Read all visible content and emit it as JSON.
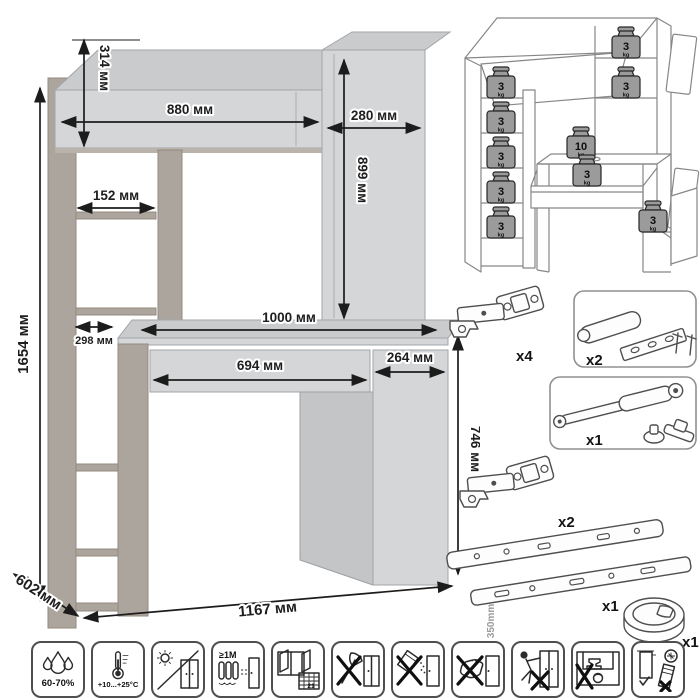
{
  "dimensions": {
    "total_height": "1654 мм",
    "hutch_height": "314 мм",
    "hutch_width": "880 мм",
    "side_cabinet_width": "280 мм",
    "side_cabinet_height": "899 мм",
    "shelf_width": "152 мм",
    "shelf_depth": "298 мм",
    "desktop_width": "1000 мм",
    "drawer_width": "694 мм",
    "pedestal_width": "264 мм",
    "desk_height": "746 мм",
    "depth": "602 мм",
    "total_width": "1167 мм"
  },
  "load": {
    "unit": "kg",
    "weights": [
      "3",
      "3",
      "3",
      "3",
      "3",
      "3",
      "3",
      "10",
      "3",
      "3"
    ]
  },
  "hardware": {
    "hinge_top_qty": "x4",
    "damper_qty": "x2",
    "gas_lift_qty": "x1",
    "hinge_bottom_qty": "x2",
    "slides_qty": "x1",
    "slides_length": "350mm",
    "grommet_qty": "x1"
  },
  "care": {
    "humidity": "60-70%",
    "temperature": "+10...+25°С",
    "min_distance": "≥1М",
    "calendar_day": "21"
  },
  "colors": {
    "panel": "#d4d6d8",
    "wood": "#aca59d",
    "dimension_lines": "#1c1c1c",
    "weight_fill": "#9b9b9b"
  }
}
